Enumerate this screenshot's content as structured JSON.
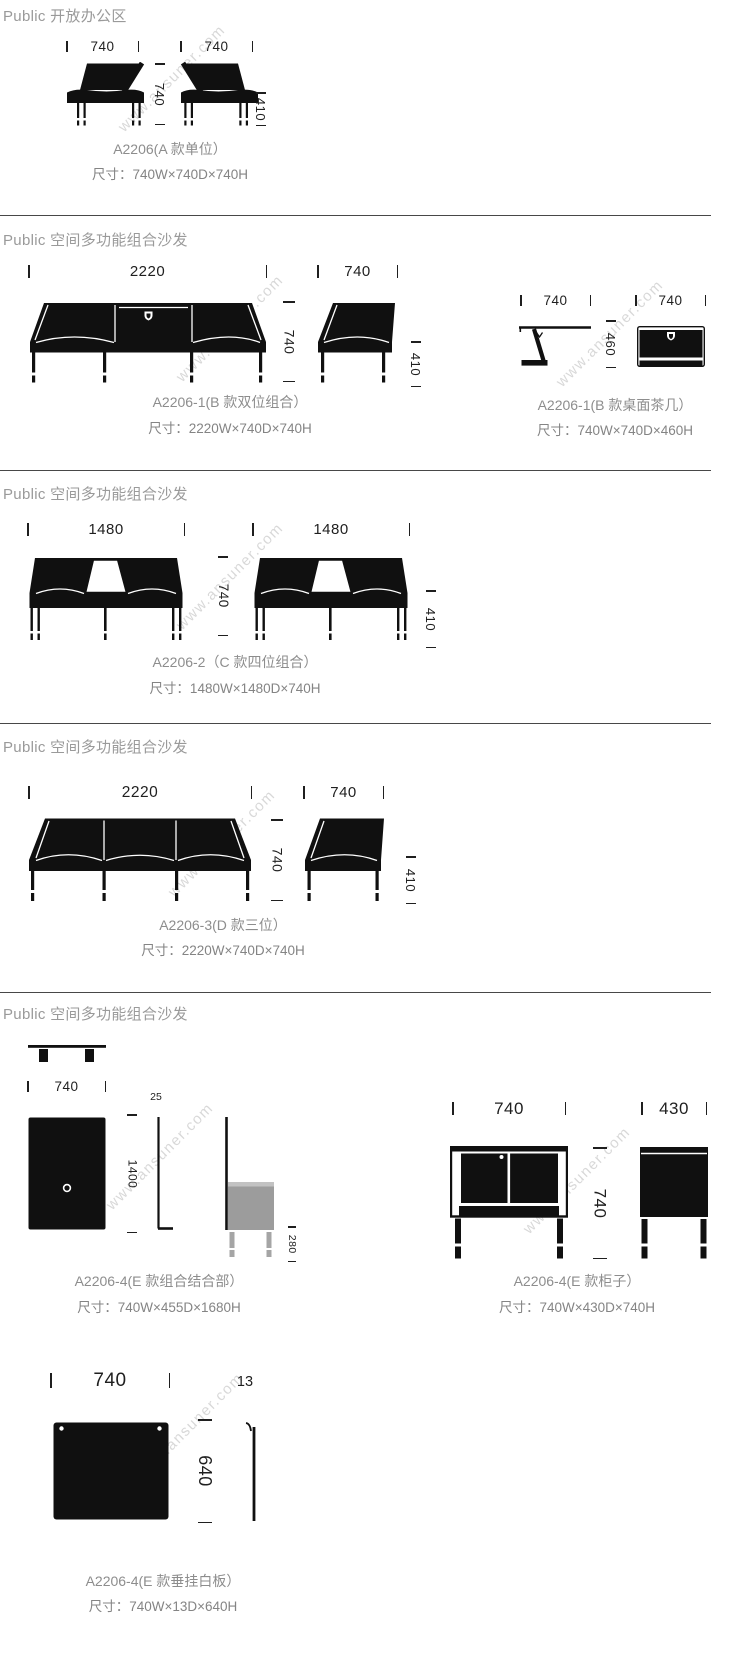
{
  "watermark": "www.ansuner.com",
  "s1": {
    "header": "Public 开放办公区",
    "dim_w1": "740",
    "dim_w2": "740",
    "dim_depth": "740",
    "dim_seat": "410",
    "name": "A2206(A 款单位）",
    "size": "尺寸：740W×740D×740H"
  },
  "s2": {
    "header": "Public 空间多功能组合沙发",
    "sofa": {
      "dim_w": "2220",
      "dim_h": "740",
      "side_w": "740",
      "seat_h": "410",
      "name": "A2206-1(B 款双位组合）",
      "size": "尺寸：2220W×740D×740H"
    },
    "table": {
      "dim_w1": "740",
      "dim_w2": "740",
      "dim_h": "460",
      "name": "A2206-1(B 款桌面茶几）",
      "size": "尺寸：740W×740D×460H"
    }
  },
  "s3": {
    "header": "Public 空间多功能组合沙发",
    "dim_w1": "1480",
    "dim_w2": "1480",
    "dim_h": "740",
    "seat_h": "410",
    "name": "A2206-2（C 款四位组合）",
    "size": "尺寸：1480W×1480D×740H"
  },
  "s4": {
    "header": "Public 空间多功能组合沙发",
    "dim_w": "2220",
    "dim_h": "740",
    "side_w": "740",
    "seat_h": "410",
    "name": "A2206-3(D 款三位）",
    "size": "尺寸：2220W×740D×740H"
  },
  "s5": {
    "header": "Public 空间多功能组合沙发",
    "combo": {
      "dim_w": "740",
      "dim_h": "1400",
      "dim_t": "25",
      "dim_box": "280",
      "name": "A2206-4(E 款组合结合部）",
      "size": "尺寸：740W×455D×1680H"
    },
    "cabinet": {
      "dim_w": "740",
      "dim_h": "740",
      "dim_d": "430",
      "name": "A2206-4(E 款柜子）",
      "size": "尺寸：740W×430D×740H"
    },
    "board": {
      "dim_w": "740",
      "dim_t": "13",
      "dim_h": "640",
      "name": "A2206-4(E 款垂挂白板）",
      "size": "尺寸：740W×13D×640H"
    }
  }
}
